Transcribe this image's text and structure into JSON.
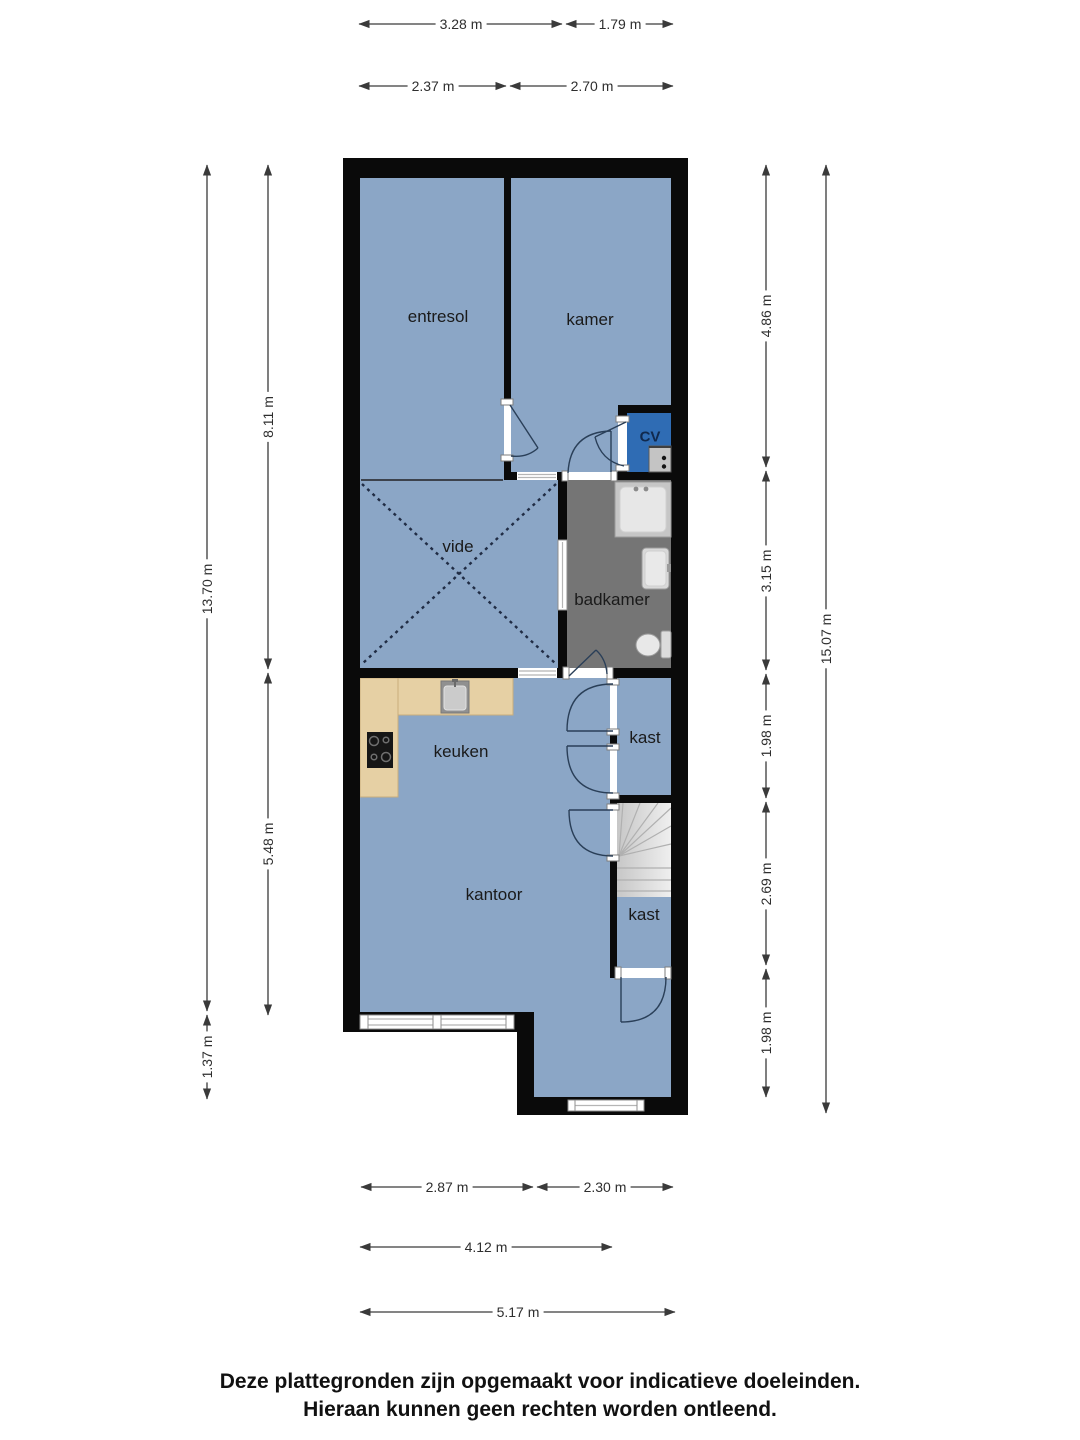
{
  "floorplan": {
    "rooms": {
      "entresol": "entresol",
      "kamer": "kamer",
      "cv": "CV",
      "vide": "vide",
      "badkamer": "badkamer",
      "keuken": "keuken",
      "kast_top": "kast",
      "kantoor": "kantoor",
      "kast_bottom": "kast"
    },
    "dimensions": {
      "top_row1": [
        "3.28 m",
        "1.79 m"
      ],
      "top_row2": [
        "2.37 m",
        "2.70 m"
      ],
      "left_outer": [
        "13.70 m",
        "1.37 m"
      ],
      "left_inner": [
        "8.11 m",
        "5.48 m"
      ],
      "right_inner": [
        "4.86 m",
        "3.15 m",
        "1.98 m",
        "2.69 m",
        "1.98 m"
      ],
      "right_outer": "15.07 m",
      "bottom_row1": [
        "2.87 m",
        "2.30 m"
      ],
      "bottom_row2": "4.12 m",
      "bottom_row3": "5.17 m"
    },
    "colors": {
      "wall": "#0a0a0a",
      "floor": "#8ba6c6",
      "cv_room": "#2f6cb4",
      "badkamer_floor": "#757575",
      "counter": "#e6d0a4",
      "stairs_base": "#d9d9d9"
    },
    "disclaimer": {
      "line1": "Deze plattegronden zijn opgemaakt voor indicatieve doeleinden.",
      "line2": "Hieraan kunnen geen rechten worden ontleend."
    }
  }
}
